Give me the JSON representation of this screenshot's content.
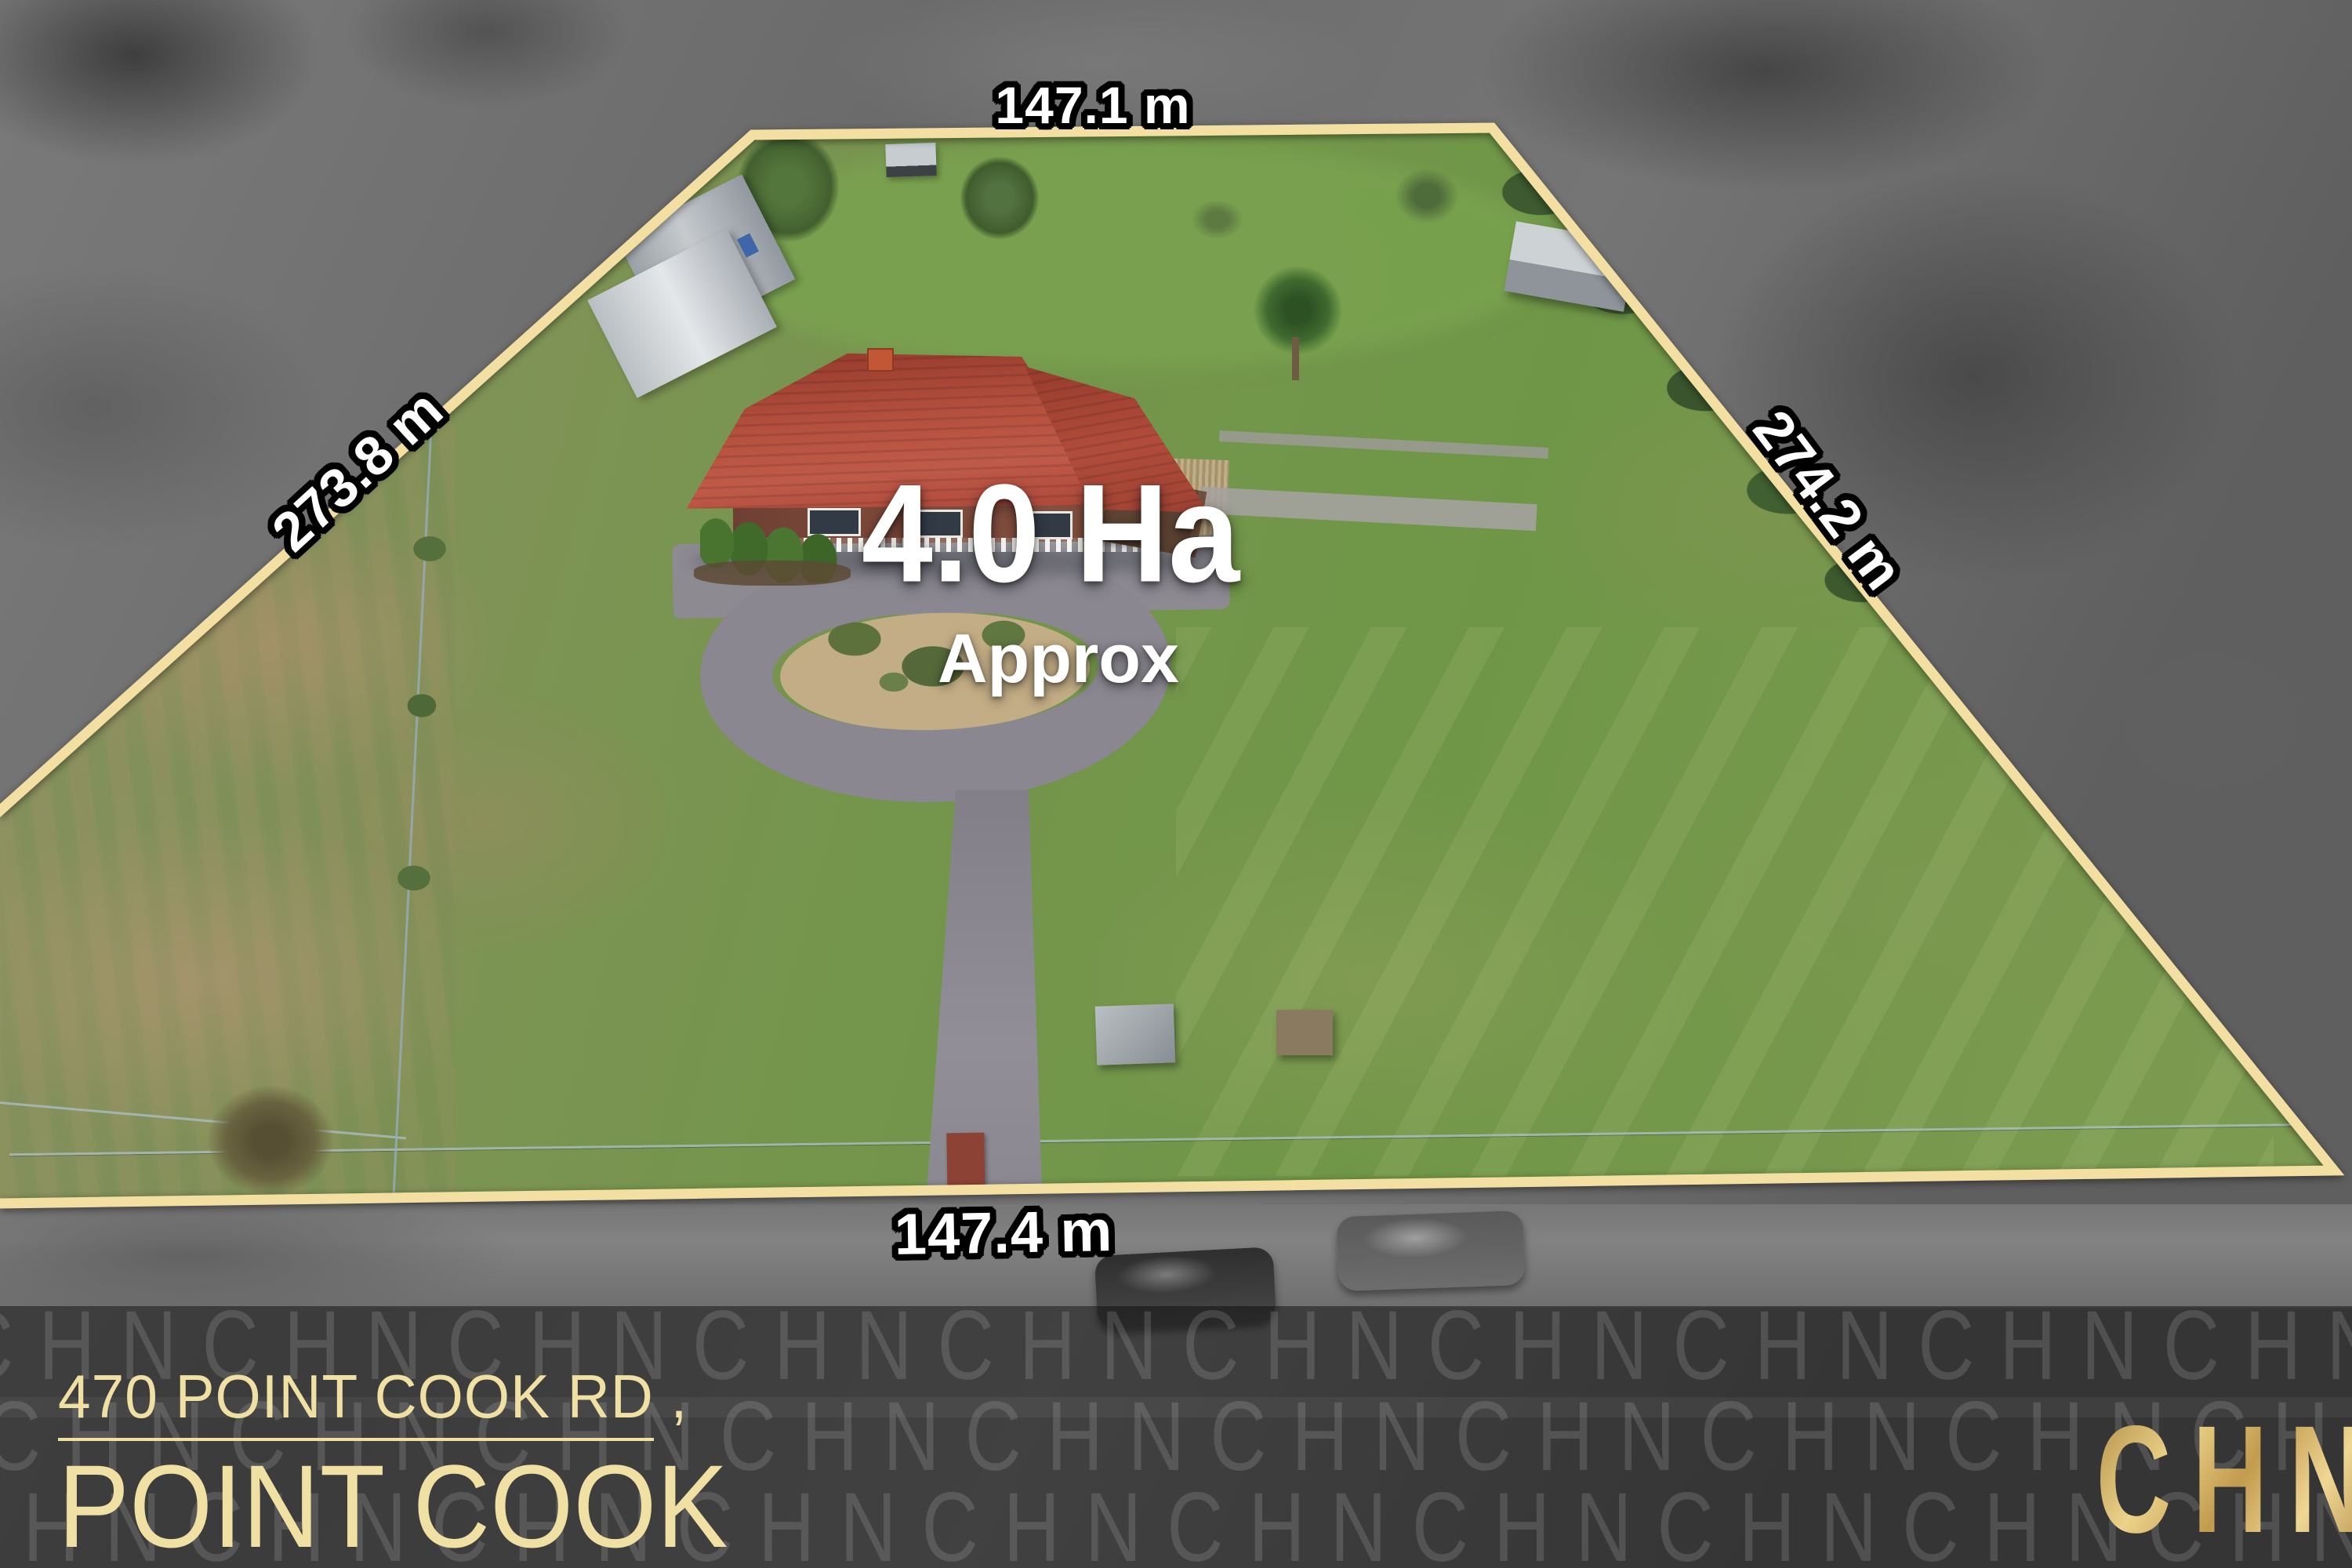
{
  "property": {
    "area_value": "4.0 Ha",
    "area_qualifier": "Approx",
    "measurements": {
      "top": "147.1 m",
      "left": "273.8 m",
      "right": "274.2 m",
      "bottom": "147.4 m"
    }
  },
  "address": {
    "line1": "470 POINT COOK RD ,",
    "line2": "POINT COOK"
  },
  "branding": {
    "logo_text": "CHN",
    "watermark_letters": "CHN"
  },
  "colors": {
    "boundary_line": "#f2dfa1",
    "measurement_text": "#ffffff",
    "measurement_outline": "#000000",
    "area_text": "#ffffff",
    "address_gold": "#f1e0a3",
    "logo_gold": "#d8b869",
    "banner_overlay": "rgba(8,8,8,0.48)",
    "roof_red": "#b5503f",
    "grass_green": "#74954c",
    "driveway_gray": "#8b8890"
  }
}
